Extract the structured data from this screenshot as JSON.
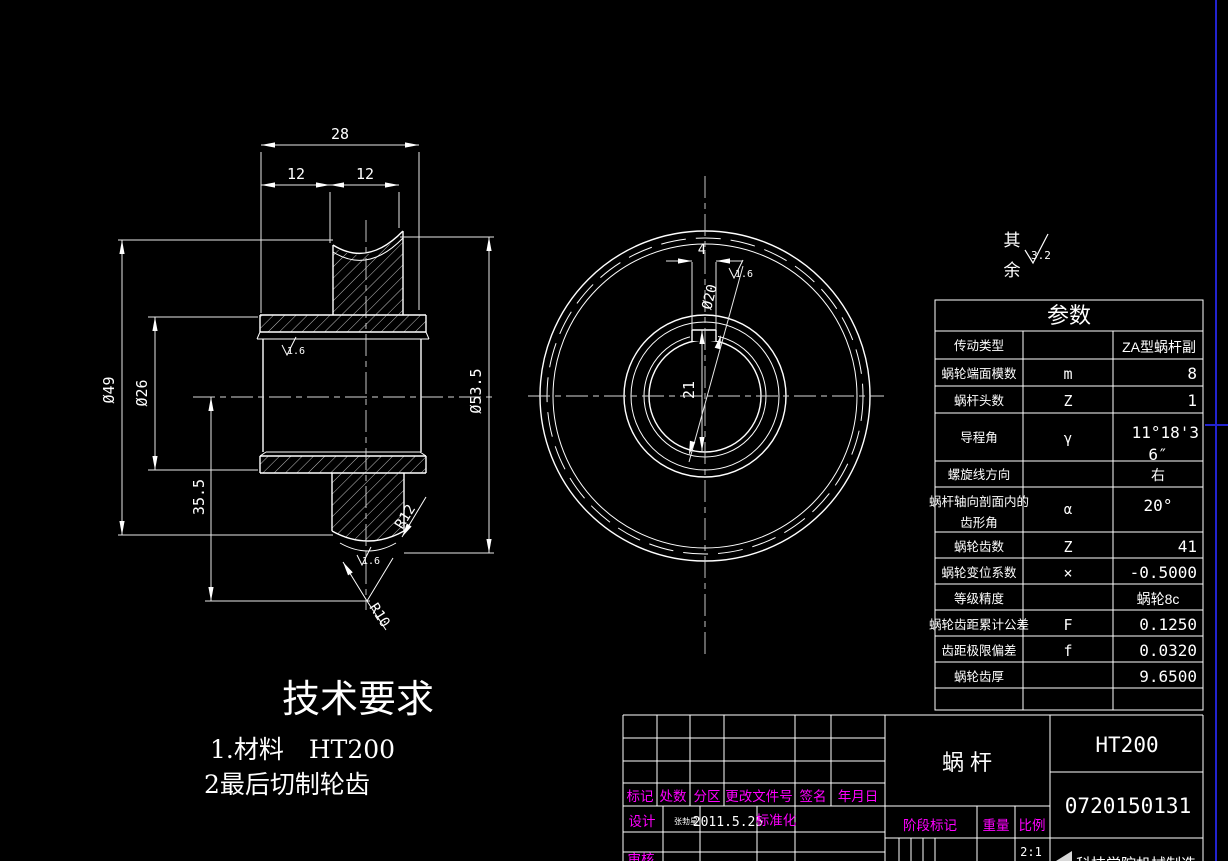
{
  "colors": {
    "background": "#000000",
    "line": "#ffffff",
    "accent_magenta": "#ff00ff",
    "frame_blue": "#2323cf"
  },
  "dims": {
    "w28": "28",
    "w12a": "12",
    "w12b": "12",
    "d49": "Ø49",
    "d26": "Ø26",
    "h355": "35.5",
    "d535": "Ø53.5",
    "r12": "R12",
    "r10": "R10",
    "kw4": "4",
    "d20": "Ø20",
    "kd21": "21"
  },
  "roughness": {
    "fine": "1.6",
    "general": "3.2",
    "rest_top": "其",
    "rest_bottom": "余"
  },
  "tech": {
    "title": "技术要求",
    "item1": "1.材料　HT200",
    "item2": "2最后切制轮齿"
  },
  "table": {
    "title": "参数",
    "rows": [
      {
        "label": "传动类型",
        "symbol": "",
        "value": "ZA型蜗杆副"
      },
      {
        "label": "蜗轮端面模数",
        "symbol": "m",
        "value": "8"
      },
      {
        "label": "蜗杆头数",
        "symbol": "Z",
        "value": "1"
      },
      {
        "label": "导程角",
        "symbol": "γ",
        "value": "11°18'36″",
        "value_line1": "11°18'3",
        "value_line2": "6″"
      },
      {
        "label": "螺旋线方向",
        "symbol": "",
        "value": "右"
      },
      {
        "label": "蜗杆轴向剖面内的齿形角",
        "label_line1": "蜗杆轴向剖面内的",
        "label_line2": "齿形角",
        "symbol": "α",
        "value": "20°"
      },
      {
        "label": "蜗轮齿数",
        "symbol": "Z",
        "value": "41"
      },
      {
        "label": "蜗轮变位系数",
        "symbol": "×",
        "value": "-0.5000"
      },
      {
        "label": "等级精度",
        "symbol": "",
        "value": "蜗轮8c"
      },
      {
        "label": "蜗轮齿距累计公差",
        "symbol": "F",
        "value": "0.1250"
      },
      {
        "label": "齿距极限偏差",
        "symbol": "f",
        "value": "0.0320"
      },
      {
        "label": "蜗轮齿厚",
        "symbol": "",
        "value": "9.6500"
      }
    ]
  },
  "tb": {
    "part_name": "蜗 杆",
    "material": "HT200",
    "drawing_no": "0720150131",
    "cols": {
      "mark": "标记",
      "qty": "处数",
      "zone": "分区",
      "change_no": "更改文件号",
      "sign": "签名",
      "date": "年月日"
    },
    "design": "设计",
    "designer": "张勃星",
    "date": "2011.5.25",
    "standardize": "标准化",
    "audit": "审核",
    "stage": "阶段标记",
    "weight": "重量",
    "scale": "比例",
    "scale_value": "2:1",
    "org": "科技学院机械制造"
  }
}
